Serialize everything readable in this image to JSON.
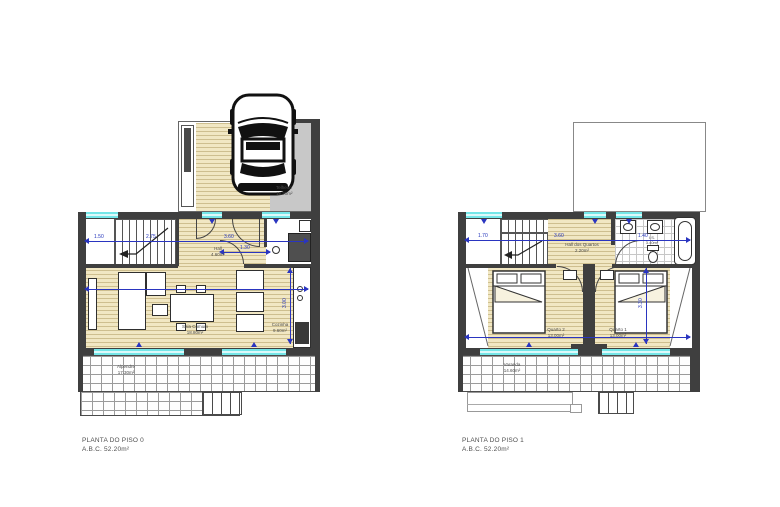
{
  "document": {
    "type": "architectural floor plan sheet",
    "background": "#ffffff"
  },
  "colors": {
    "wall": "#3f3f3f",
    "wood_floor": "#f1e7c3",
    "window_glass": "#74e6e8",
    "dimension_blue": "#2a35c0",
    "concrete": "#c8c8c8",
    "grid_line": "#9b9b9b"
  },
  "plans": [
    {
      "title": "PLANTA DO PISO 0",
      "abc": "A.B.C. 52.20m²",
      "rooms": [
        {
          "name": "Telheiro",
          "area": "18.20m²"
        },
        {
          "name": "Hall",
          "area": "4.60m²"
        },
        {
          "name": "Sala Comum",
          "area": "18.80m²"
        },
        {
          "name": "Cozinha",
          "area": "9.60m²"
        },
        {
          "name": "Alpendre",
          "area": "17.30m²"
        }
      ],
      "dimensions": [
        "1.50",
        "2.75",
        "3.60",
        "1.30",
        "3.00"
      ]
    },
    {
      "title": "PLANTA DO PISO 1",
      "abc": "A.B.C. 52.20m²",
      "rooms": [
        {
          "name": "Hall dos Quartos",
          "area": "2.20m²"
        },
        {
          "name": "I.S.",
          "area": "3.40m²"
        },
        {
          "name": "Quarto 2",
          "area": "13.00m²"
        },
        {
          "name": "Quarto 1",
          "area": "13.00m²"
        },
        {
          "name": "Varanda",
          "area": "14.60m²"
        }
      ],
      "dimensions": [
        "1.70",
        "3.60",
        "1.40",
        "3.30"
      ]
    }
  ]
}
